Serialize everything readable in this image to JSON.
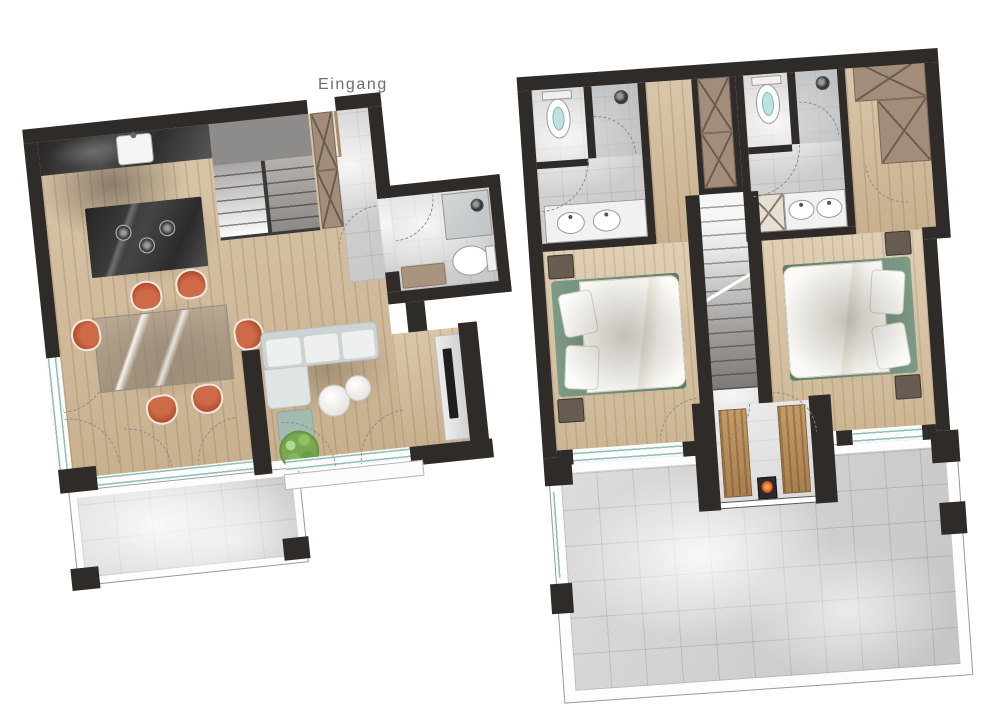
{
  "labels": {
    "entrance": "Eingang"
  },
  "palette": {
    "wall": "#2e2b28",
    "wood_floor": "#d6c2a4",
    "bedroom_wood": "#dcc9ae",
    "tile_light": "#d8d8d8",
    "tile_grout": "#b9b9b9",
    "counter_dark": "#3c3c3c",
    "wardrobe_brown": "#a28d7b",
    "wardrobe_line": "#6d5c4d",
    "stair_light": "#f2f2f2",
    "stair_dark": "#757371",
    "window_teal": "#8fc0ba",
    "chair_terracotta": "#c2593a",
    "sofa_gray": "#d3d9da",
    "ottoman_teal": "#a3bab1",
    "pouf_white": "#f4f3f0",
    "plant_green": "#7fae54",
    "bed_green": "#6f8b7a",
    "duvet_white": "#f7f5f0",
    "nightstand_brown": "#5f564e",
    "sauna_wood": "#b48a58",
    "heater_orange": "#d8552c",
    "fixture_white": "#ffffff",
    "fixture_line": "#9a9a9a",
    "label_gray": "#6d6d6d",
    "background": "#ffffff"
  },
  "plans": [
    {
      "id": "ground-floor",
      "rooms": [
        "entry-hall",
        "kitchen",
        "dining-area",
        "living-room",
        "bathroom",
        "staircase",
        "terrace"
      ],
      "fixtures": [
        "kitchen-sink",
        "cooktop",
        "kitchen-island",
        "dining-table",
        "dining-chairs",
        "sofa",
        "ottoman",
        "poufs",
        "plant",
        "tv-console",
        "shower",
        "toilet",
        "vanity",
        "wardrobe",
        "stairs"
      ]
    },
    {
      "id": "upper-floor",
      "rooms": [
        "bedroom-left",
        "bedroom-right",
        "ensuite-left",
        "ensuite-right",
        "hallway",
        "staircase",
        "sauna",
        "roof-terrace"
      ],
      "fixtures": [
        "toilet",
        "shower",
        "double-vanity",
        "wardrobes",
        "double-bed",
        "nightstands",
        "sauna-benches",
        "sauna-heater",
        "stairs"
      ]
    }
  ]
}
